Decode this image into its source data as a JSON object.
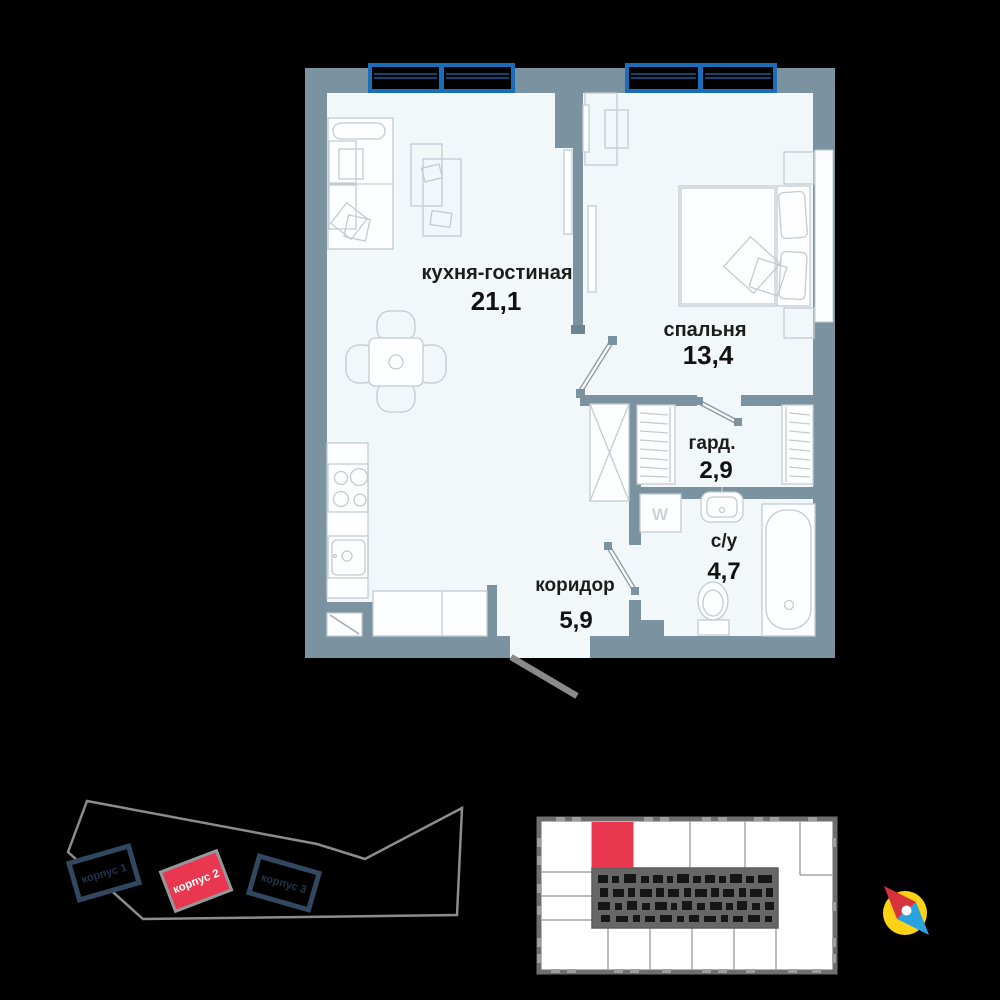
{
  "plan": {
    "rooms": [
      {
        "id": "kitchen-living",
        "name": "кухня-гостиная",
        "area": "21,1"
      },
      {
        "id": "bedroom",
        "name": "спальня",
        "area": "13,4"
      },
      {
        "id": "wardrobe",
        "name": "гард.",
        "area": "2,9"
      },
      {
        "id": "bathroom",
        "name": "с/у",
        "area": "4,7"
      },
      {
        "id": "corridor",
        "name": "коридор",
        "area": "5,9"
      }
    ],
    "washer_label": "W"
  },
  "site_plan": {
    "buildings": [
      {
        "label": "корпус 1",
        "state": "normal"
      },
      {
        "label": "корпус 2",
        "state": "selected"
      },
      {
        "label": "корпус 3",
        "state": "normal"
      }
    ]
  },
  "floor_plate": {
    "selected_unit": "highlighted-red"
  },
  "colors": {
    "accent_red": "#e8374e",
    "window_blue": "#1a6db8",
    "wall": "#7b93a1",
    "floor": "#f2f7f9",
    "compass_yellow": "#ffd216",
    "compass_red": "#d7333f",
    "compass_blue": "#2aa2de"
  }
}
